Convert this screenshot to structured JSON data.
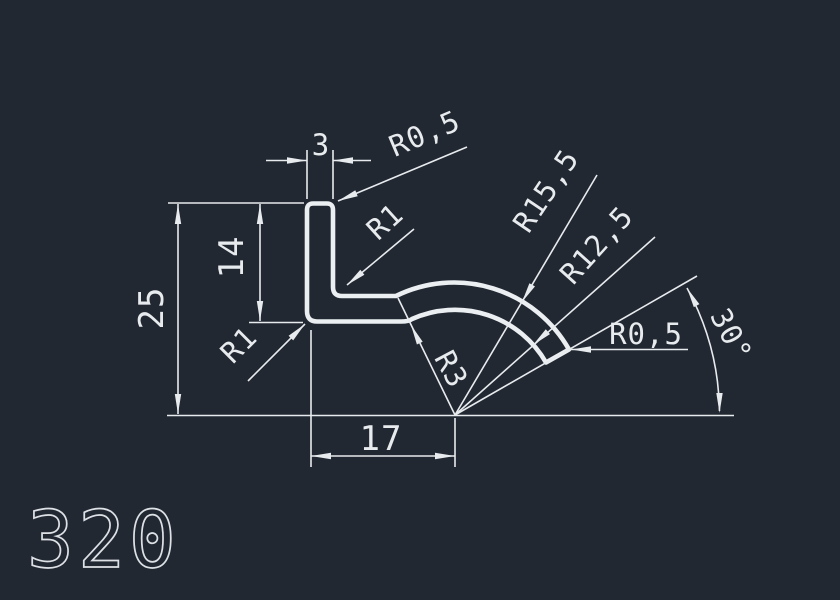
{
  "colors": {
    "background": "#212832",
    "line": "#e8ebee"
  },
  "drawing": {
    "part_number": "320",
    "labels": {
      "top_width": "3",
      "radius_top": "R0,5",
      "radius_inner_corner": "R1",
      "height_total": "25",
      "height_flange": "14",
      "radius_outer_corner": "R1",
      "radius_transition": "R3",
      "radius_outer_arc": "R15,5",
      "radius_inner_arc": "R12,5",
      "radius_tip": "R0,5",
      "angle": "30°",
      "bottom_length": "17"
    }
  }
}
